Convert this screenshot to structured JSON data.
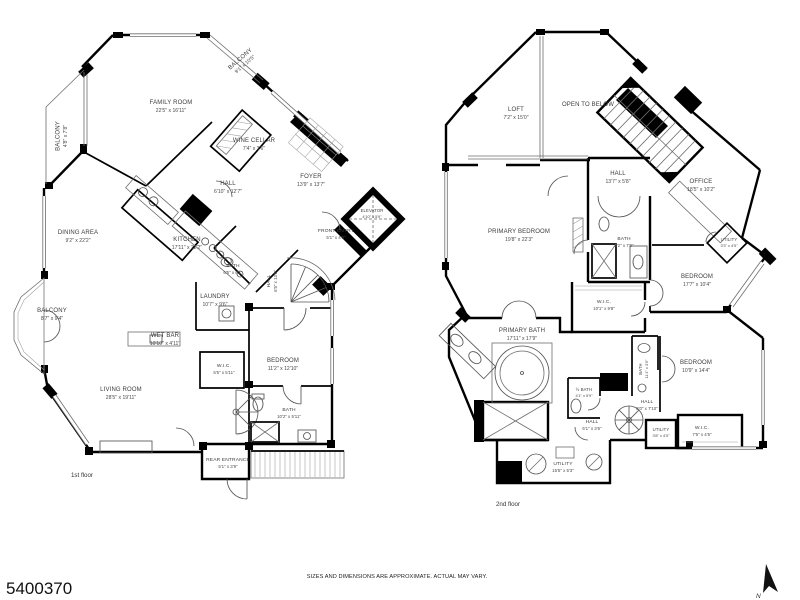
{
  "floor1": {
    "label": "1st floor",
    "rooms": [
      {
        "name": "FAMILY ROOM",
        "dims": "22'5\" x 16'11\""
      },
      {
        "name": "BALCONY",
        "dims": "9'1\" x 10'5\""
      },
      {
        "name": "BALCONY",
        "dims": "4'8\" x 7'8\""
      },
      {
        "name": "WINE CELLAR",
        "dims": "7'4\" x 3'6\""
      },
      {
        "name": "HALL",
        "dims": "6'10\" x 12'7\""
      },
      {
        "name": "FOYER",
        "dims": "13'9\" x 13'7\""
      },
      {
        "name": "ELEVATOR",
        "dims": "4'10\" x 5'9\""
      },
      {
        "name": "FRONT ENTRY",
        "dims": "5'1\" x 4'0\""
      },
      {
        "name": "DINING AREA",
        "dims": "9'2\" x 22'2\""
      },
      {
        "name": "KITCHEN",
        "dims": "17'11\" x 22'2\""
      },
      {
        "name": "BATH",
        "dims": "6'5\" x 6'1\""
      },
      {
        "name": "LAUNDRY",
        "dims": "10'7\" x 9'6\""
      },
      {
        "name": "BALCONY",
        "dims": "8'7\" x 9'4\""
      },
      {
        "name": "WET BAR",
        "dims": "10'10\" x 4'11\""
      },
      {
        "name": "W.I.C.",
        "dims": "5'5\" x 5'11\""
      },
      {
        "name": "LIVING ROOM",
        "dims": "28'5\" x 19'11\""
      },
      {
        "name": "BEDROOM",
        "dims": "11'2\" x 12'10\""
      },
      {
        "name": "BATH",
        "dims": "10'2\" x 5'11\""
      },
      {
        "name": "HALL",
        "dims": "6'5\" x 13'0\""
      },
      {
        "name": "REAR ENTRANCE",
        "dims": "5'1\" x 3'9\""
      }
    ]
  },
  "floor2": {
    "label": "2nd floor",
    "rooms": [
      {
        "name": "LOFT",
        "dims": "7'2\" x 15'0\""
      },
      {
        "name": "OPEN TO BELOW",
        "dims": ""
      },
      {
        "name": "HALL",
        "dims": "13'7\" x 5'8\""
      },
      {
        "name": "OFFICE",
        "dims": "18'5\" x 10'2\""
      },
      {
        "name": "PRIMARY BEDROOM",
        "dims": "19'8\" x 22'3\""
      },
      {
        "name": "BATH",
        "dims": "8'2\" x 7'9\""
      },
      {
        "name": "UTILITY",
        "dims": "3'3\" x 4'5\""
      },
      {
        "name": "BEDROOM",
        "dims": "17'7\" x 10'4\""
      },
      {
        "name": "W.I.C.",
        "dims": "10'1\" x 9'8\""
      },
      {
        "name": "PRIMARY BATH",
        "dims": "17'11\" x 17'9\""
      },
      {
        "name": "BATH",
        "dims": "11'4\" x 3'0\""
      },
      {
        "name": "½ BATH",
        "dims": "4'1\" x 5'9\""
      },
      {
        "name": "HALL",
        "dims": "6'1\" x 3'6\""
      },
      {
        "name": "BEDROOM",
        "dims": "10'9\" x 14'4\""
      },
      {
        "name": "HALL",
        "dims": "8'0\" x 7'10\""
      },
      {
        "name": "UTILITY",
        "dims": "3'8\" x 4'5\""
      },
      {
        "name": "W.I.C.",
        "dims": "7'5\" x 4'5\""
      },
      {
        "name": "UTILITY",
        "dims": "15'5\" x 5'3\""
      }
    ]
  },
  "footer": {
    "mls_number": "5400370",
    "disclaimer": "SIZES AND DIMENSIONS ARE APPROXIMATE. ACTUAL MAY VARY.",
    "compass_label": "N"
  }
}
